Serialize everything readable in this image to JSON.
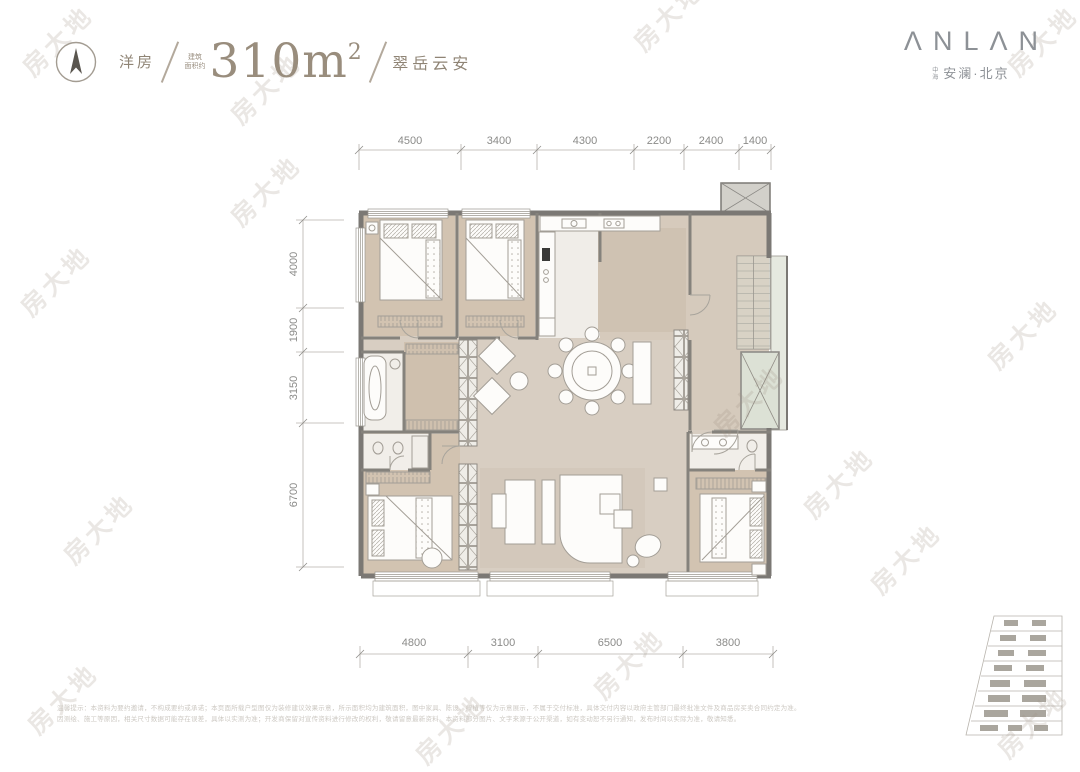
{
  "header": {
    "property_type": "洋房",
    "area_prefix_line1": "建筑",
    "area_prefix_line2": "面积约",
    "area_value": "310m",
    "area_superscript": "2",
    "plan_name": "翠岳云安",
    "brand": {
      "logo": "ΛNLΛN",
      "sub_prefix": "中海",
      "sub": "安澜·北京"
    }
  },
  "floorplan": {
    "dims_top": [
      "4500",
      "3400",
      "4300",
      "2200",
      "2400",
      "1400"
    ],
    "dims_left": [
      "4000",
      "1900",
      "3150",
      "6700"
    ],
    "dims_bottom": [
      "4800",
      "3100",
      "6500",
      "3800"
    ]
  },
  "watermark": {
    "text": "房大地",
    "positions": [
      [
        57,
        40
      ],
      [
        265,
        88
      ],
      [
        668,
        15
      ],
      [
        1042,
        40
      ],
      [
        265,
        190
      ],
      [
        55,
        280
      ],
      [
        1022,
        333
      ],
      [
        748,
        400
      ],
      [
        838,
        482
      ],
      [
        98,
        528
      ],
      [
        905,
        558
      ],
      [
        628,
        663
      ],
      [
        62,
        698
      ],
      [
        450,
        728
      ],
      [
        1032,
        722
      ]
    ]
  },
  "footer": {
    "line1": "温馨提示：本资料为要约邀请，不构成要约或承诺；本页面所载户型图仅为装修建议效果示意，所示面积均为建筑面积，图中家具、陈设、绿植等仅为示意展示，不属于交付标准，具体交付内容以政府主管部门最终批准文件及商品房买卖合同约定为准。",
    "line2": "因测绘、施工等原因，相关尺寸数据可能存在误差，具体以实测为准；开发商保留对宣传资料进行修改的权利，敬请留意最新资料。本资料部分图片、文字来源于公开渠道，如有变动恕不另行通知，发布时间以实际为准，敬请知悉。"
  },
  "colors": {
    "title_text": "#988c7c",
    "logo_text": "#8d9196",
    "dimension_text": "#8b8b89",
    "wall": "#7b7874",
    "floor_beige": "#d8cec2",
    "floor_tan": "#d2c3b1",
    "core_green": "#dfe3d8",
    "watermark": "rgba(158,146,130,0.22)"
  }
}
